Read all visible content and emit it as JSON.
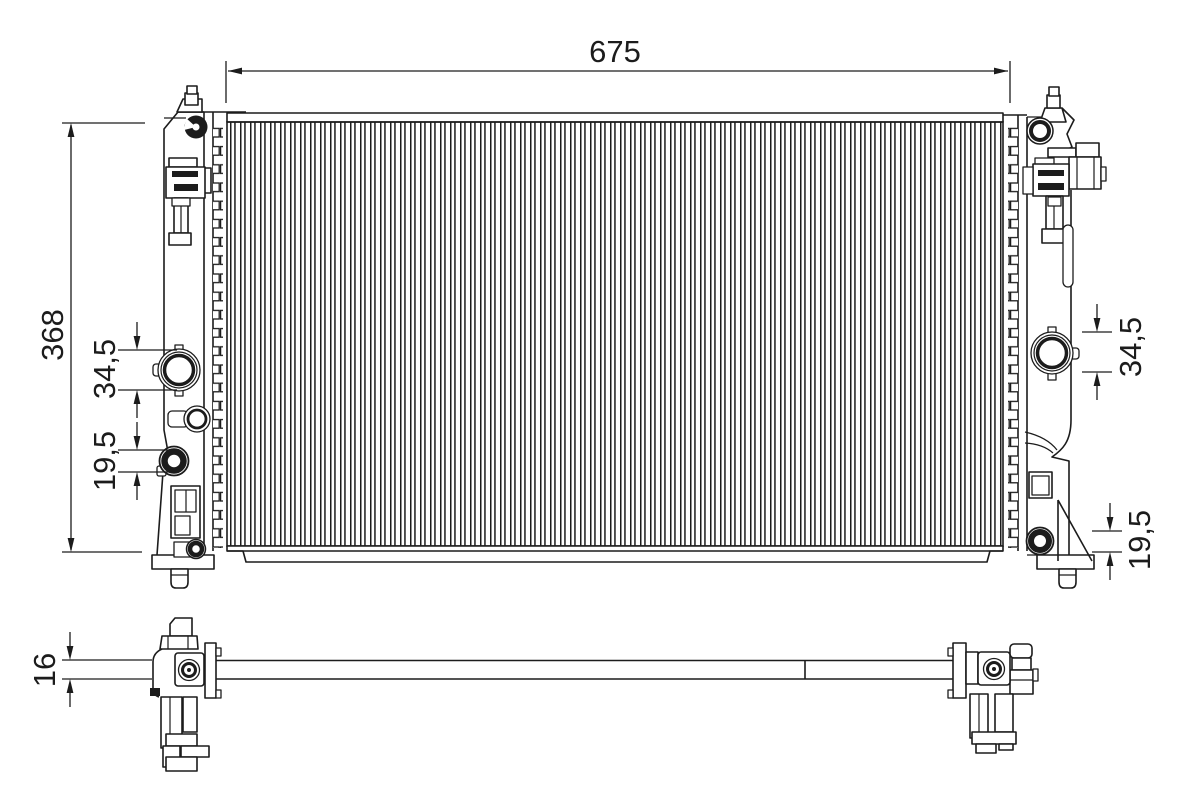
{
  "drawing_labels": {
    "width": "675",
    "height": "368",
    "left_upper_port_diameter": "34,5",
    "left_lower_port_diameter": "19,5",
    "right_upper_port_diameter": "34,5",
    "right_lower_port_diameter": "19,5",
    "thickness": "16"
  },
  "colors": {
    "line": "#1c1c1c",
    "background": "#ffffff"
  }
}
